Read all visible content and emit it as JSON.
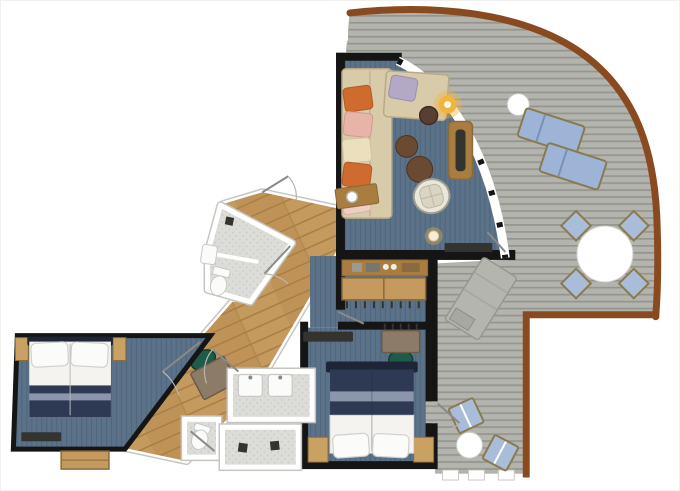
{
  "title": "suite-floor-plan",
  "colors": {
    "background": "#ffffff",
    "wall": "#151515",
    "deck_plank": "#b4b4ae",
    "deck_plank_line": "#95958f",
    "deck_trim": "#8a4a20",
    "carpet": "#5b7289",
    "carpet_line": "#4f667d",
    "wood_floor": "#c59a5f",
    "wood_floor_line": "#a87f45",
    "wood_floor_alt": "#b98e52",
    "tile": "#dcdcd8",
    "tile_dot": "#c6c6c2",
    "tile_dark": "#d2d2ce",
    "fixture": "#fbfbfa",
    "fixture_stroke": "#c8c8c4",
    "sofa": "#d8cbaa",
    "sofa_stroke": "#b9a988",
    "cushion_orange": "#cf6b2e",
    "cushion_pink": "#e8b4aa",
    "cushion_cream": "#ebdfbd",
    "cushion_lavender": "#b3a8c6",
    "cushion_blush": "#edcdc6",
    "table_brown": "#6b4a32",
    "table_brown_dark": "#574031",
    "wood_furniture": "#a97c3f",
    "wardrobe_wood": "#c49a5e",
    "lamp_glow": "#f2b43c",
    "wicker": "#e9e7db",
    "wicker_stroke": "#a0a090",
    "bed_navy": "#2e3a54",
    "bed_headboard": "#1d2536",
    "bed_band": "#8b96ac",
    "bed_white": "#f4f3f0",
    "pillow": "#fbfbfa",
    "nightstand": "#c9a263",
    "desk": "#8b7b67",
    "desk_stroke": "#6a5a48",
    "chair_green": "#1e5c49",
    "lounger_blue": "#9db4d6",
    "chair_blue": "#a9bdd8",
    "frame_tan": "#8a7a50",
    "gray_lounger": "#b5b5af",
    "tv_dark": "#33332f",
    "white": "#ffffff",
    "door": "#8a8a86",
    "door_arc": "#b6b6b0"
  },
  "rooms": [
    {
      "id": "balcony-deck",
      "floor": "gray-plank-decking"
    },
    {
      "id": "living-room",
      "floor": "blue-carpet"
    },
    {
      "id": "dressing-corridor",
      "floor": "blue-carpet"
    },
    {
      "id": "bedroom-main",
      "floor": "blue-carpet"
    },
    {
      "id": "bedroom-second",
      "floor": "blue-carpet"
    },
    {
      "id": "hallway",
      "floor": "oak-wood"
    },
    {
      "id": "bathroom-upper",
      "floor": "gray-tile"
    },
    {
      "id": "bathroom-double-sink",
      "floor": "gray-tile"
    },
    {
      "id": "shower-room",
      "floor": "gray-tile"
    },
    {
      "id": "wc",
      "floor": "gray-tile"
    }
  ],
  "furniture": [
    "corner-sofa",
    "chaise",
    "floor-lamp",
    "side-table",
    "ottomans",
    "console-table",
    "wicker-chair",
    "tv-console",
    "minibar-counter",
    "wardrobe",
    "double-bed-1",
    "double-bed-2",
    "nightstands",
    "vanity-desk",
    "hall-desk",
    "green-chairs",
    "toilets",
    "sinks",
    "showers",
    "sun-loungers",
    "deck-dining-table",
    "deck-chairs",
    "gray-daybed",
    "round-deck-tables"
  ]
}
